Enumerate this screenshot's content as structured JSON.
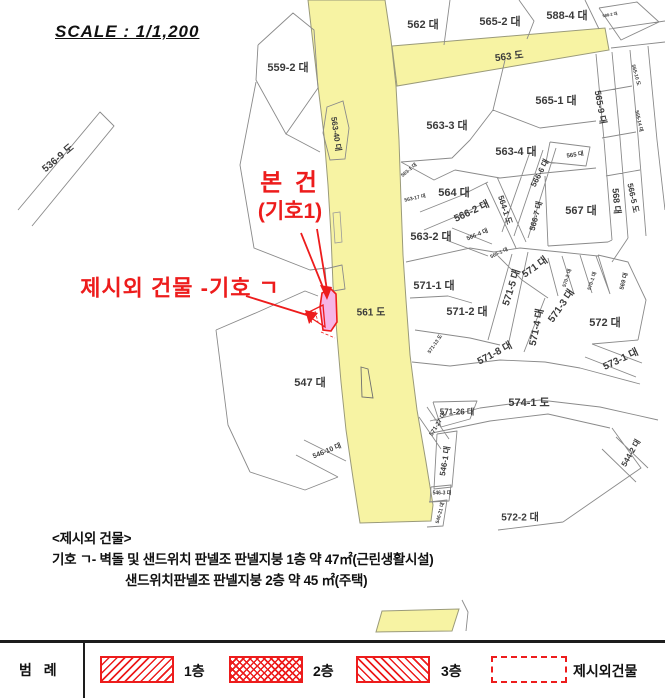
{
  "scale_label": "SCALE : 1/1,200",
  "annotations": {
    "subject_line1": "본 건",
    "subject_line2": "(기호1)",
    "extra_building": "제시외 건물 -기호 ㄱ"
  },
  "notes": {
    "title": "<제시외 건물>",
    "line1": "기호 ㄱ- 벽돌 및 샌드위치 판넬조 판넬지붕 1층 약 47㎡(근린생활시설)",
    "line2": "샌드위치판넬조 판넬지붕 2층 약 45 ㎡(주택)"
  },
  "legend": {
    "title": "범 례",
    "items": [
      {
        "label": "1층",
        "hatch": "diag"
      },
      {
        "label": "2층",
        "hatch": "cross"
      },
      {
        "label": "3층",
        "hatch": "back"
      },
      {
        "label": "제시외건물",
        "hatch": "dashed"
      }
    ]
  },
  "map": {
    "colors": {
      "road": "#f7f3a3",
      "building": "#f6b5e6",
      "annotation_red": "#ed1c1c",
      "parcel_line": "#8a8a8a"
    },
    "road_names": [
      "561 도",
      "563 도",
      "574-1 도"
    ],
    "labels": [
      {
        "text": "562 대",
        "x": 423,
        "y": 24,
        "size": 11
      },
      {
        "text": "565-2 대",
        "x": 500,
        "y": 21,
        "size": 11
      },
      {
        "text": "588-4 대",
        "x": 567,
        "y": 15,
        "size": 11
      },
      {
        "text": "588-2 대",
        "x": 610,
        "y": 15,
        "size": 4,
        "rot": -10
      },
      {
        "text": "563 도",
        "x": 509,
        "y": 55,
        "size": 10,
        "rot": -7
      },
      {
        "text": "559-2 대",
        "x": 288,
        "y": 67,
        "size": 11
      },
      {
        "text": "536-9 도",
        "x": 57,
        "y": 157,
        "size": 10,
        "rot": -40
      },
      {
        "text": "563-40 대",
        "x": 336,
        "y": 134,
        "size": 8,
        "rot": 82
      },
      {
        "text": "565-1 대",
        "x": 556,
        "y": 100,
        "size": 11
      },
      {
        "text": "565-9 대",
        "x": 601,
        "y": 107,
        "size": 9,
        "rot": 80
      },
      {
        "text": "565-10 도",
        "x": 636,
        "y": 75,
        "size": 5,
        "rot": 75
      },
      {
        "text": "565-14 대",
        "x": 639,
        "y": 121,
        "size": 5,
        "rot": 78
      },
      {
        "text": "563-3 대",
        "x": 447,
        "y": 125,
        "size": 11
      },
      {
        "text": "563-4 대",
        "x": 516,
        "y": 151,
        "size": 11
      },
      {
        "text": "565 대",
        "x": 575,
        "y": 154,
        "size": 6,
        "rot": -8
      },
      {
        "text": "567 대",
        "x": 581,
        "y": 210,
        "size": 11
      },
      {
        "text": "568 대",
        "x": 617,
        "y": 201,
        "size": 9,
        "rot": 85
      },
      {
        "text": "566-5 도",
        "x": 633,
        "y": 198,
        "size": 8,
        "rot": 78
      },
      {
        "text": "564 대",
        "x": 454,
        "y": 192,
        "size": 11
      },
      {
        "text": "563-1 대",
        "x": 409,
        "y": 170,
        "size": 5,
        "rot": -40
      },
      {
        "text": "563-17 대",
        "x": 415,
        "y": 198,
        "size": 5,
        "rot": -12
      },
      {
        "text": "566-2 대",
        "x": 471,
        "y": 210,
        "size": 10,
        "rot": -25
      },
      {
        "text": "564-1 도",
        "x": 505,
        "y": 210,
        "size": 8,
        "rot": 72
      },
      {
        "text": "566-6 대",
        "x": 540,
        "y": 173,
        "size": 8,
        "rot": -62
      },
      {
        "text": "566-7 대",
        "x": 536,
        "y": 216,
        "size": 8,
        "rot": -75
      },
      {
        "text": "563-2 대",
        "x": 431,
        "y": 236,
        "size": 11
      },
      {
        "text": "566-4 대",
        "x": 477,
        "y": 234,
        "size": 6,
        "rot": -22
      },
      {
        "text": "566-1 대",
        "x": 499,
        "y": 253,
        "size": 5,
        "rot": -25
      },
      {
        "text": "571-1 대",
        "x": 434,
        "y": 285,
        "size": 11
      },
      {
        "text": "571 대",
        "x": 534,
        "y": 266,
        "size": 10,
        "rot": -35
      },
      {
        "text": "571-5 대",
        "x": 510,
        "y": 287,
        "size": 10,
        "rot": -72
      },
      {
        "text": "571-2 대",
        "x": 467,
        "y": 311,
        "size": 11
      },
      {
        "text": "571-3 대",
        "x": 560,
        "y": 305,
        "size": 10,
        "rot": -55
      },
      {
        "text": "571-4 대",
        "x": 535,
        "y": 327,
        "size": 10,
        "rot": -78
      },
      {
        "text": "571-8 대",
        "x": 494,
        "y": 352,
        "size": 10,
        "rot": -28
      },
      {
        "text": "571-13 도",
        "x": 435,
        "y": 344,
        "size": 5,
        "rot": -55
      },
      {
        "text": "570-2 대",
        "x": 567,
        "y": 278,
        "size": 5,
        "rot": -72
      },
      {
        "text": "570-1 대",
        "x": 592,
        "y": 281,
        "size": 5,
        "rot": -72
      },
      {
        "text": "569 대",
        "x": 623,
        "y": 281,
        "size": 6,
        "rot": -75
      },
      {
        "text": "572 대",
        "x": 605,
        "y": 322,
        "size": 11
      },
      {
        "text": "573-1 대",
        "x": 620,
        "y": 358,
        "size": 10,
        "rot": -25
      },
      {
        "text": "561 도",
        "x": 371,
        "y": 311,
        "size": 10
      },
      {
        "text": "547 대",
        "x": 310,
        "y": 382,
        "size": 11
      },
      {
        "text": "574-1 도",
        "x": 529,
        "y": 402,
        "size": 11
      },
      {
        "text": "571-26 대",
        "x": 457,
        "y": 412,
        "size": 8
      },
      {
        "text": "571-27 대",
        "x": 437,
        "y": 424,
        "size": 6,
        "rot": -58
      },
      {
        "text": "546-1 대",
        "x": 445,
        "y": 461,
        "size": 8,
        "rot": -80
      },
      {
        "text": "546-3 대",
        "x": 442,
        "y": 493,
        "size": 5
      },
      {
        "text": "546-21 대",
        "x": 440,
        "y": 513,
        "size": 5,
        "rot": -75
      },
      {
        "text": "546-10 대",
        "x": 327,
        "y": 451,
        "size": 7,
        "rot": -22
      },
      {
        "text": "544-2 대",
        "x": 631,
        "y": 453,
        "size": 8,
        "rot": -60
      },
      {
        "text": "572-2 대",
        "x": 520,
        "y": 516,
        "size": 10
      }
    ]
  }
}
